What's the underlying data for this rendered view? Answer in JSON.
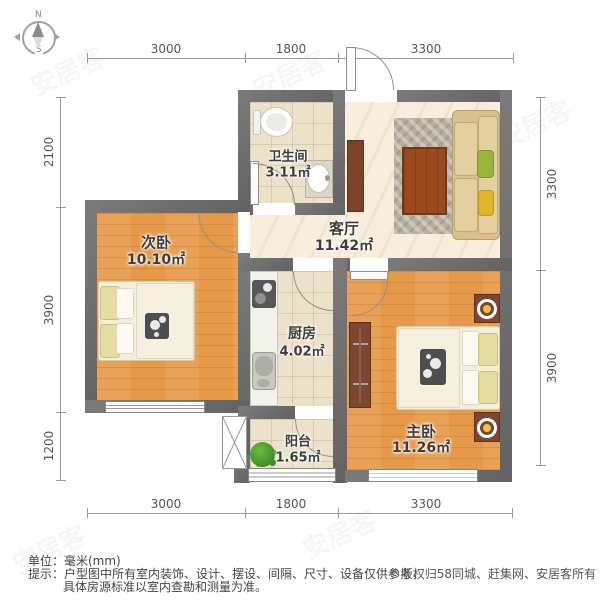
{
  "compass": {
    "north": "N",
    "south": "S"
  },
  "dimensions": {
    "top": [
      "3000",
      "1800",
      "3300"
    ],
    "bottom": [
      "3000",
      "1800",
      "3300"
    ],
    "left": [
      "2100",
      "3900",
      "1200"
    ],
    "right": [
      "3300",
      "3900"
    ]
  },
  "rooms": {
    "bathroom": {
      "name": "卫生间",
      "area": "3.11㎡"
    },
    "living": {
      "name": "客厅",
      "area": "11.42㎡"
    },
    "secondary_bedroom": {
      "name": "次卧",
      "area": "10.10㎡"
    },
    "kitchen": {
      "name": "厨房",
      "area": "4.02㎡"
    },
    "master_bedroom": {
      "name": "主卧",
      "area": "11.26㎡"
    },
    "balcony": {
      "name": "阳台",
      "area": "1.65㎡"
    }
  },
  "footer": {
    "unit": "单位：毫米(mm)",
    "tip_line1": "提示：户型图中所有室内装饰、设计、摆设、间隔、尺寸、设备仅供参考，",
    "tip_line2": "具体房源标准以室内查勘和测量为准。",
    "copyright": "©版权归58同城、赶集网、安居客所有"
  },
  "watermark": {
    "text": "安居客"
  },
  "colors": {
    "wall": "#6b6b6b",
    "wood_floor": "#e69a49",
    "living_floor": "#f7eedd",
    "tile_floor": "#ece2c9",
    "accent_wood": "#9a4a1d",
    "lamp": "#eec043"
  }
}
